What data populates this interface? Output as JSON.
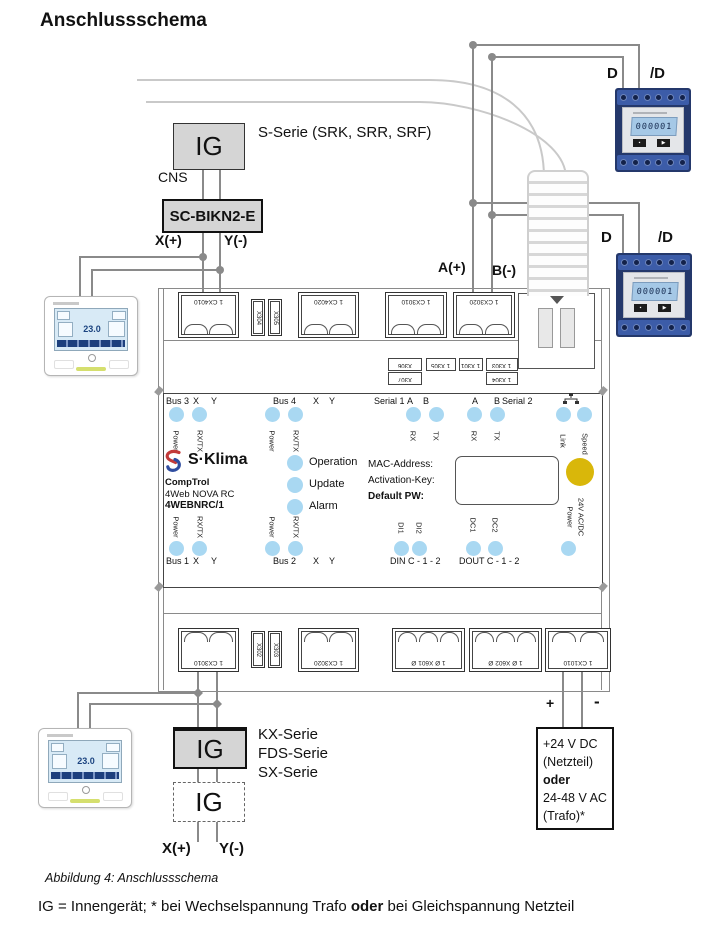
{
  "colors": {
    "wire": "#8a8a8a",
    "light_wire": "#c9c9c9",
    "led_blue": "#a9d8f2",
    "status_yellow": "#d9b70a",
    "box_gray": "#d5d5d5",
    "meter_body": "#24386b",
    "meter_strip": "#3c5ca8",
    "lcd_blue": "#a5c8e6"
  },
  "page": {
    "title": "Anschlussschema",
    "caption": "Abbildung 4: Anschlussschema",
    "footnote_pre": "IG = Innengerät; * bei Wechselspannung Trafo ",
    "footnote_bold": "oder",
    "footnote_post": " bei Gleichspannung Netzteil"
  },
  "top_branch": {
    "ig": "IG",
    "series": "S-Serie (SRK, SRR, SRF)",
    "cns": "CNS",
    "adapter": "SC-BIKN2-E",
    "x": "X(+)",
    "y": "Y(-)"
  },
  "meters": {
    "d": "D",
    "nd": "/D",
    "display": "000001"
  },
  "ab_bus": {
    "a": "A(+)",
    "b": "B(-)"
  },
  "remote": {
    "temp": "23.0"
  },
  "device": {
    "brand": "S·Klima",
    "product": [
      "CompTrol",
      "4Web NOVA RC",
      "4WEBNRC/1"
    ],
    "status": [
      "Operation",
      "Update",
      "Alarm"
    ],
    "info": [
      "MAC-Address:",
      "Activation-Key:",
      "Default PW:"
    ],
    "headers": {
      "bus3": "Bus 3",
      "bus4": "Bus 4",
      "bus1": "Bus 1",
      "bus2": "Bus 2",
      "serial1": "Serial 1",
      "serial2": "Serial 2",
      "x": "X",
      "y": "Y",
      "a": "A",
      "b": "B",
      "din": "DIN C - 1 - 2",
      "dout": "DOUT C - 1 - 2"
    },
    "led_labels": {
      "power": "Power",
      "rxtx": "RX/TX",
      "rx": "RX",
      "tx": "TX",
      "link": "Link",
      "speed": "Speed",
      "di1": "DI1",
      "di2": "DI2",
      "dc1": "DC1",
      "dc2": "DC2",
      "pwr1": "Power",
      "pwr2": "24V AC/DC"
    },
    "terminals": {
      "t401": "1 CX4010",
      "t402": "1 CX4020",
      "tser1": "1 CX3010",
      "tser2": "1 CX3020",
      "s_top": [
        "X304",
        "X305"
      ],
      "tags_r1": [
        "X306",
        "1 X305",
        "1 X301",
        "1 X303"
      ],
      "tags_r2": [
        "X307",
        "1 X304"
      ],
      "b301": "1 CX3010",
      "b302": "1 CX3020",
      "s_bot": [
        "X302",
        "X303"
      ],
      "x601": "1 Ø X601 Ø",
      "x602": "1 Ø X602 Ø",
      "t101": "1 CX1010"
    }
  },
  "bottom_branch": {
    "ig": "IG",
    "series": [
      "KX-Serie",
      "FDS-Serie",
      "SX-Serie"
    ],
    "ig_dashed": "IG",
    "x": "X(+)",
    "y": "Y(-)"
  },
  "power_supply": {
    "plus": "+",
    "minus": "-",
    "lines": [
      "+24 V DC",
      "(Netzteil)",
      "oder",
      "24-48 V AC",
      "(Trafo)*"
    ]
  }
}
